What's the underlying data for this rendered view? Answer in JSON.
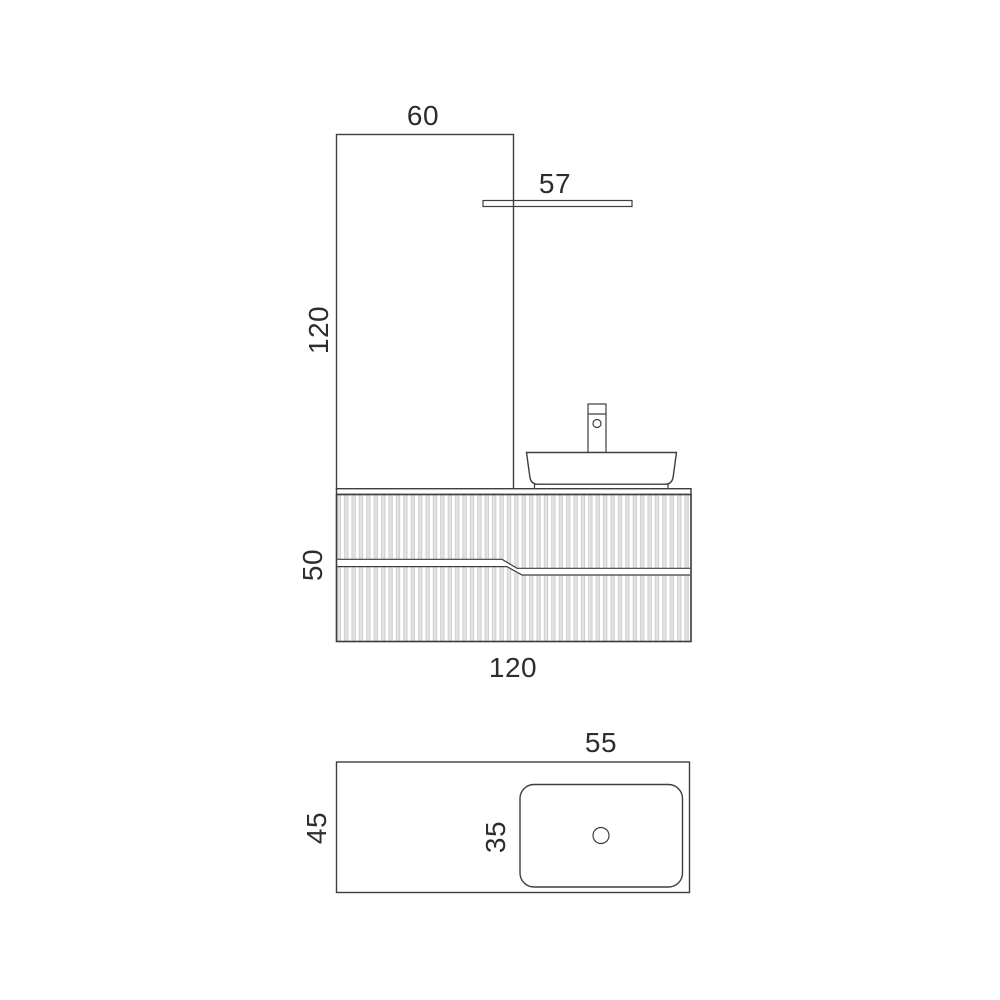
{
  "front_view": {
    "mirror_width": "60",
    "shelf_width": "57",
    "mirror_height": "120",
    "cabinet_height": "50",
    "cabinet_width": "120"
  },
  "plan_view": {
    "basin_width": "55",
    "counter_depth": "45",
    "basin_depth": "35"
  },
  "colors": {
    "line": "#3e3e3e",
    "text": "#2d2d2d",
    "flute_fill": "#e2e2e2",
    "flute_edge": "#c2c2c2",
    "background": "#ffffff"
  }
}
